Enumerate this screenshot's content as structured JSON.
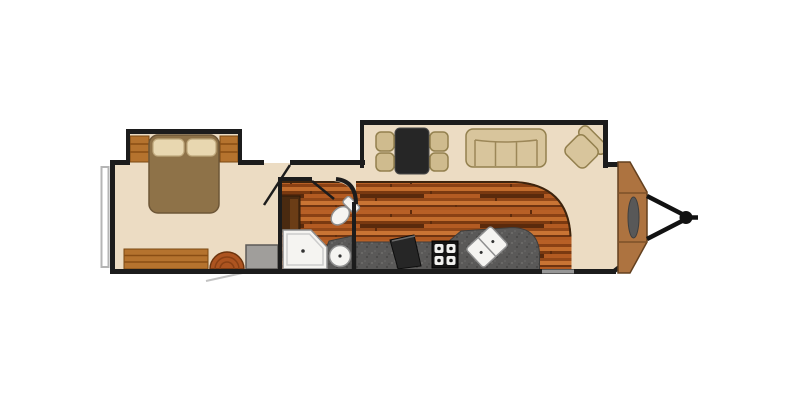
{
  "canvas": {
    "width": 800,
    "height": 400,
    "background": "#ffffff"
  },
  "floorplan": {
    "type": "travel-trailer-floor-plan",
    "orientation": "hitch-on-right",
    "colors": {
      "wall": "#1c1c1c",
      "floor": "#ecdcc3",
      "wood_floor": "#a8531d",
      "wood_edge": "#3c240e",
      "counter": "#5a5958",
      "counter_edge": "#3e3d3c",
      "cabinet": "#b5732e",
      "cabinet_dark": "#4a2a10",
      "cabinet_dark_inner": "#6b3d16",
      "wardrobe_gray": "#a09e9b",
      "upholstery": "#d8c59c",
      "upholstery_dark": "#cfbb8e",
      "bed_blanket": "#8e7248",
      "pillow": "#e8d7b0",
      "table_dark": "#262626",
      "appliance_black": "#141414",
      "fridge_black": "#262626",
      "fixture_white": "#f5f4f1",
      "front_cap": "#ad7340",
      "front_cap_seam": "#7c5128",
      "hitch": "#121212",
      "window": "#969696",
      "tv_gray": "#585858",
      "ottoman": "#ad5420",
      "bumper_outline": "#b5b5b5",
      "awning_line": "#c2c2c2"
    },
    "fixtures": [
      "bed",
      "pillows",
      "nightstand-left",
      "nightstand-right",
      "dresser",
      "ottoman",
      "wardrobe",
      "linen-cabinet",
      "shower",
      "toilet",
      "bathroom-sink",
      "bathroom-counter",
      "kitchen-counter",
      "refrigerator",
      "stove",
      "kitchen-sink",
      "dinette-table",
      "dinette-chairs",
      "sofa",
      "recliner",
      "front-cap",
      "tv",
      "hitch",
      "rear-bumper",
      "bedroom-slideout",
      "dinette-slideout"
    ]
  }
}
